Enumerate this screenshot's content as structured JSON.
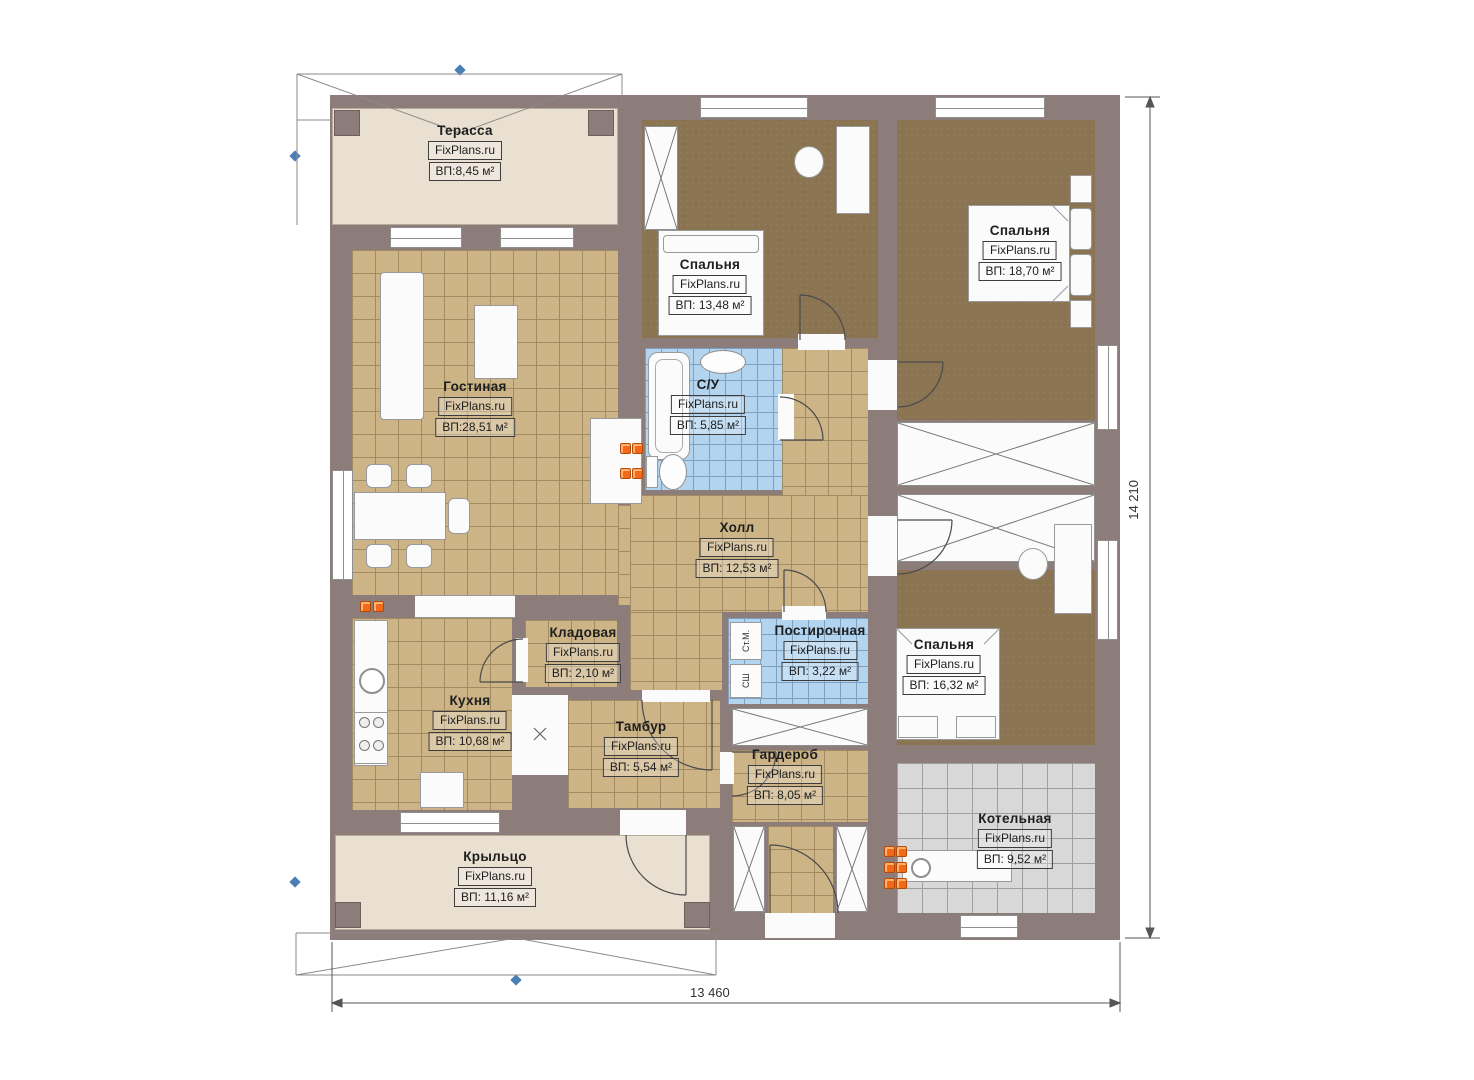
{
  "plan": {
    "title": "Floor plan one-storey house",
    "brand": "FixPlans.ru",
    "rooms": [
      {
        "id": "terrace",
        "name": "Терасса",
        "brand": "FixPlans.ru",
        "area": "ВП:8,45 м²"
      },
      {
        "id": "bedroom-top",
        "name": "Спальня",
        "brand": "FixPlans.ru",
        "area": "ВП: 13,48 м²"
      },
      {
        "id": "bedroom-right",
        "name": "Спальня",
        "brand": "FixPlans.ru",
        "area": "ВП: 18,70 м²"
      },
      {
        "id": "living-room",
        "name": "Гостиная",
        "brand": "FixPlans.ru",
        "area": "ВП:28,51 м²"
      },
      {
        "id": "bathroom",
        "name": "С/У",
        "brand": "FixPlans.ru",
        "area": "ВП: 5,85 м²"
      },
      {
        "id": "hall",
        "name": "Холл",
        "brand": "FixPlans.ru",
        "area": "ВП: 12,53 м²"
      },
      {
        "id": "storage",
        "name": "Кладовая",
        "brand": "FixPlans.ru",
        "area": "ВП: 2,10 м²"
      },
      {
        "id": "kitchen",
        "name": "Кухня",
        "brand": "FixPlans.ru",
        "area": "ВП: 10,68 м²"
      },
      {
        "id": "vestibule",
        "name": "Тамбур",
        "brand": "FixPlans.ru",
        "area": "ВП: 5,54 м²"
      },
      {
        "id": "laundry",
        "name": "Постирочная",
        "brand": "FixPlans.ru",
        "area": "ВП: 3,22 м²"
      },
      {
        "id": "bedroom-bottom",
        "name": "Спальня",
        "brand": "FixPlans.ru",
        "area": "ВП: 16,32 м²"
      },
      {
        "id": "wardrobe",
        "name": "Гардероб",
        "brand": "FixPlans.ru",
        "area": "ВП: 8,05 м²"
      },
      {
        "id": "boiler-room",
        "name": "Котельная",
        "brand": "FixPlans.ru",
        "area": "ВП: 9,52 м²"
      },
      {
        "id": "porch",
        "name": "Крыльцо",
        "brand": "FixPlans.ru",
        "area": "ВП: 11,16 м²"
      }
    ],
    "appliances": {
      "washer": "Ст.М.",
      "dryer": "СШ"
    },
    "dimensions": {
      "height": "14 210",
      "width": "13 460"
    },
    "colors": {
      "wall": "#8c7c7a",
      "floor_tile": "#cdb487",
      "floor_carpet": "#8b7452",
      "tile_bath": "#b3d4ef",
      "tile_boiler": "#d8d8d8",
      "terrace": "#eae0d1",
      "heat_marker": "#f2691a",
      "axis_marker": "#4a7fb5"
    }
  }
}
